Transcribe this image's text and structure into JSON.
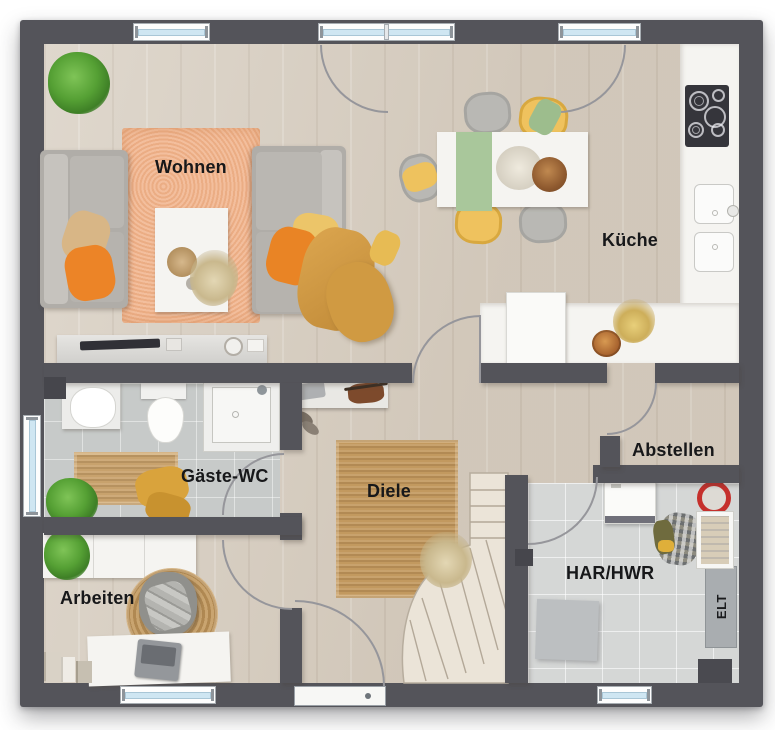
{
  "rooms": {
    "wohnen": {
      "label": "Wohnen"
    },
    "kueche": {
      "label": "Küche"
    },
    "gaeste_wc": {
      "label": "Gäste-WC"
    },
    "diele": {
      "label": "Diele"
    },
    "abstellen": {
      "label": "Abstellen"
    },
    "arbeiten": {
      "label": "Arbeiten"
    },
    "har_hwr": {
      "label": "HAR/HWR"
    },
    "elt": {
      "label": "ELT"
    }
  },
  "palette": {
    "wall": "#54545a",
    "wood_floor": "#d8cfc2",
    "tile_wc": "#c7cac9",
    "tile_hwr": "#d5d7d6",
    "rug_living": "#f1b48d",
    "rug_jute": "#c2995f",
    "accent_orange": "#ea8426",
    "accent_yellow": "#ecc460",
    "accent_green": "#9dbd8d",
    "plant_green": "#55a034",
    "window_glass": "#cfe6f2",
    "counter_white": "#f4f4f2",
    "label_text": "#17181a"
  }
}
